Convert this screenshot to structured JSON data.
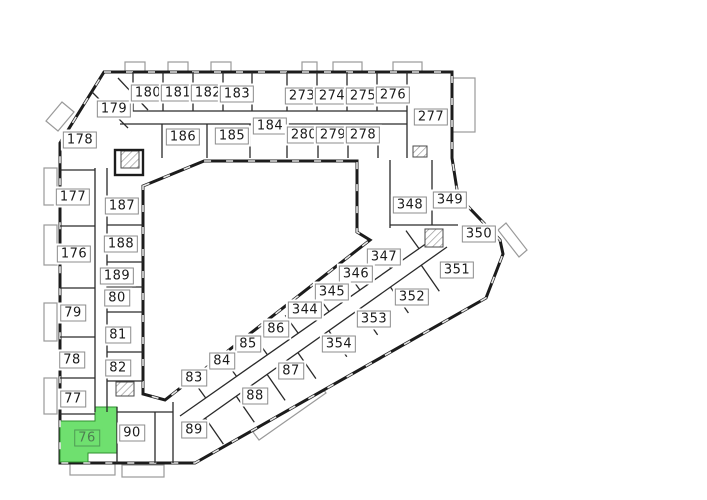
{
  "plan": {
    "name": "building-floor-plan",
    "selected_unit": "76",
    "colors": {
      "wall": "#1c1c1c",
      "balcony_outline": "#9a9a9a",
      "highlight_fill": "#6fe06f",
      "highlight_border": "#4f9a55",
      "highlight_text": "#4e7d52",
      "label_bg": "#ffffff",
      "label_border": "#8c8c8c",
      "label_text": "#1a1a1a"
    },
    "units": [
      {
        "id": "179",
        "x": 114,
        "y": 109
      },
      {
        "id": "180",
        "x": 148,
        "y": 93
      },
      {
        "id": "181",
        "x": 178,
        "y": 93
      },
      {
        "id": "182",
        "x": 208,
        "y": 93
      },
      {
        "id": "183",
        "x": 237,
        "y": 94
      },
      {
        "id": "273",
        "x": 302,
        "y": 96
      },
      {
        "id": "274",
        "x": 332,
        "y": 96
      },
      {
        "id": "275",
        "x": 363,
        "y": 96
      },
      {
        "id": "276",
        "x": 393,
        "y": 95
      },
      {
        "id": "277",
        "x": 431,
        "y": 117
      },
      {
        "id": "178",
        "x": 80,
        "y": 140
      },
      {
        "id": "186",
        "x": 183,
        "y": 137
      },
      {
        "id": "185",
        "x": 232,
        "y": 136
      },
      {
        "id": "184",
        "x": 270,
        "y": 126
      },
      {
        "id": "280",
        "x": 304,
        "y": 135
      },
      {
        "id": "279",
        "x": 333,
        "y": 135
      },
      {
        "id": "278",
        "x": 363,
        "y": 135
      },
      {
        "id": "177",
        "x": 73,
        "y": 197
      },
      {
        "id": "187",
        "x": 122,
        "y": 206
      },
      {
        "id": "176",
        "x": 74,
        "y": 254
      },
      {
        "id": "188",
        "x": 121,
        "y": 244
      },
      {
        "id": "189",
        "x": 117,
        "y": 276
      },
      {
        "id": "80",
        "x": 117,
        "y": 298
      },
      {
        "id": "79",
        "x": 73,
        "y": 313
      },
      {
        "id": "81",
        "x": 118,
        "y": 335
      },
      {
        "id": "78",
        "x": 72,
        "y": 360
      },
      {
        "id": "82",
        "x": 118,
        "y": 368
      },
      {
        "id": "77",
        "x": 73,
        "y": 399
      },
      {
        "id": "76",
        "x": 87,
        "y": 438,
        "selected": true
      },
      {
        "id": "90",
        "x": 132,
        "y": 433
      },
      {
        "id": "89",
        "x": 194,
        "y": 430
      },
      {
        "id": "348",
        "x": 410,
        "y": 205
      },
      {
        "id": "349",
        "x": 450,
        "y": 200
      },
      {
        "id": "350",
        "x": 479,
        "y": 234
      },
      {
        "id": "347",
        "x": 384,
        "y": 257
      },
      {
        "id": "351",
        "x": 457,
        "y": 270
      },
      {
        "id": "346",
        "x": 356,
        "y": 274
      },
      {
        "id": "352",
        "x": 412,
        "y": 297
      },
      {
        "id": "345",
        "x": 332,
        "y": 292
      },
      {
        "id": "344",
        "x": 305,
        "y": 310
      },
      {
        "id": "353",
        "x": 374,
        "y": 319
      },
      {
        "id": "86",
        "x": 276,
        "y": 329
      },
      {
        "id": "354",
        "x": 339,
        "y": 344
      },
      {
        "id": "85",
        "x": 248,
        "y": 344
      },
      {
        "id": "84",
        "x": 222,
        "y": 361
      },
      {
        "id": "87",
        "x": 291,
        "y": 371
      },
      {
        "id": "83",
        "x": 194,
        "y": 378
      },
      {
        "id": "88",
        "x": 255,
        "y": 396
      }
    ]
  }
}
